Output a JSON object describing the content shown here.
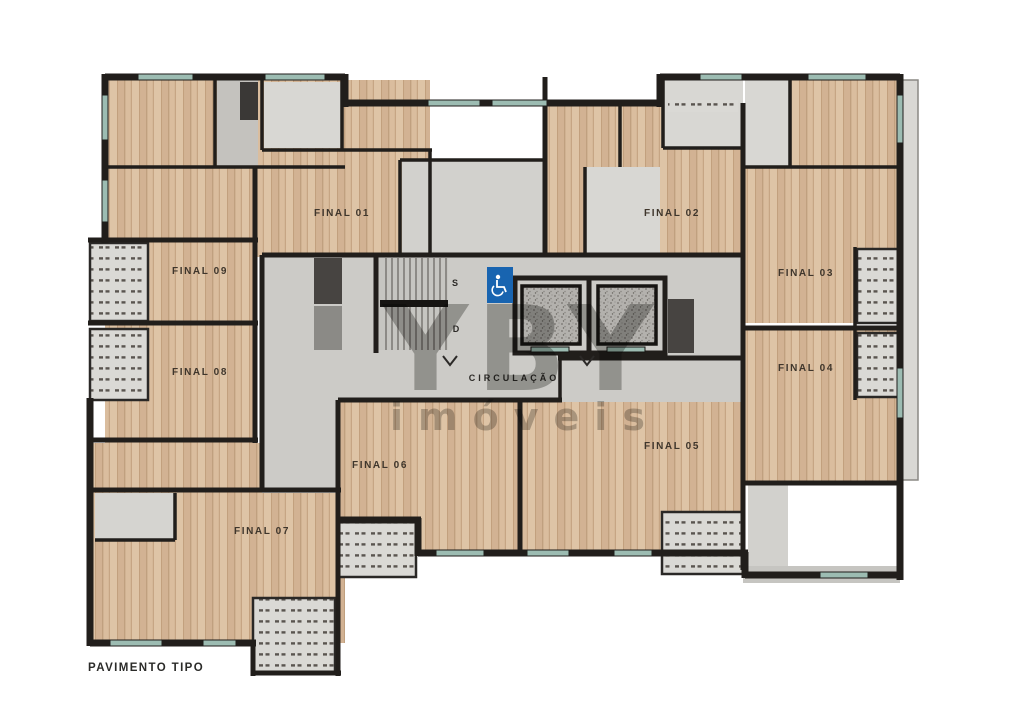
{
  "title": {
    "label": "PAVIMENTO TIPO"
  },
  "units": [
    {
      "id": "final-01",
      "label": "FINAL 01"
    },
    {
      "id": "final-02",
      "label": "FINAL 02"
    },
    {
      "id": "final-03",
      "label": "FINAL 03"
    },
    {
      "id": "final-04",
      "label": "FINAL 04"
    },
    {
      "id": "final-05",
      "label": "FINAL 05"
    },
    {
      "id": "final-06",
      "label": "FINAL 06"
    },
    {
      "id": "final-07",
      "label": "FINAL 07"
    },
    {
      "id": "final-08",
      "label": "FINAL 08"
    },
    {
      "id": "final-09",
      "label": "FINAL 09"
    }
  ],
  "circulation": {
    "label": "CIRCULAÇÃO",
    "stairs_up_label": "S",
    "stairs_down_label": "D"
  },
  "watermark": {
    "brand": "YBY",
    "tagline": "imóveis"
  },
  "icons": {
    "accessibility": "wheelchair-icon",
    "elevator": "elevator-shaft",
    "door_swing": "chevron-down"
  },
  "colors": {
    "wood": "#d7ba9b",
    "wood_plank_dark": "#c2a07e",
    "wall": "#211e1b",
    "circulation_gray": "#cccbc7",
    "room_gray": "#d8d7d3",
    "balcony_gray": "#dad9d5",
    "balcony_dash": "#5a5550",
    "window_teal": "#9cbcb2",
    "accessibility_blue": "#1864b0",
    "elevator_speckle": "#b3b1ad",
    "watermark_gray": "#8b8b88",
    "label_text": "#3f362c"
  }
}
